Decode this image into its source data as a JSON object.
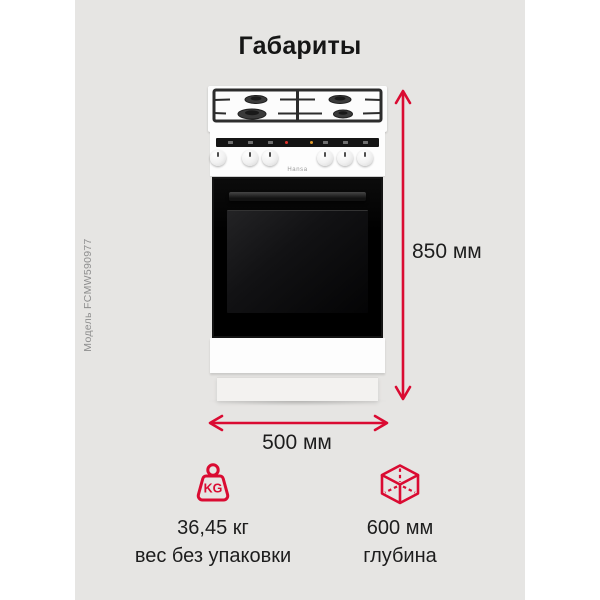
{
  "title": "Габариты",
  "watermark": "Модель FCMW590977",
  "stove": {
    "brand": "Hansa"
  },
  "dimensions": {
    "height": "850 мм",
    "width": "500 мм"
  },
  "specs": {
    "weight": {
      "icon": "kg-weight-icon",
      "value": "36,45 кг",
      "caption": "вес без упаковки"
    },
    "depth": {
      "icon": "cube-icon",
      "value": "600 мм",
      "caption": "глубина"
    }
  },
  "colors": {
    "accent_red": "#da0b32",
    "card_background": "#e6e5e3",
    "text": "#1d1d1d",
    "watermark_text": "#8e8e8e"
  }
}
